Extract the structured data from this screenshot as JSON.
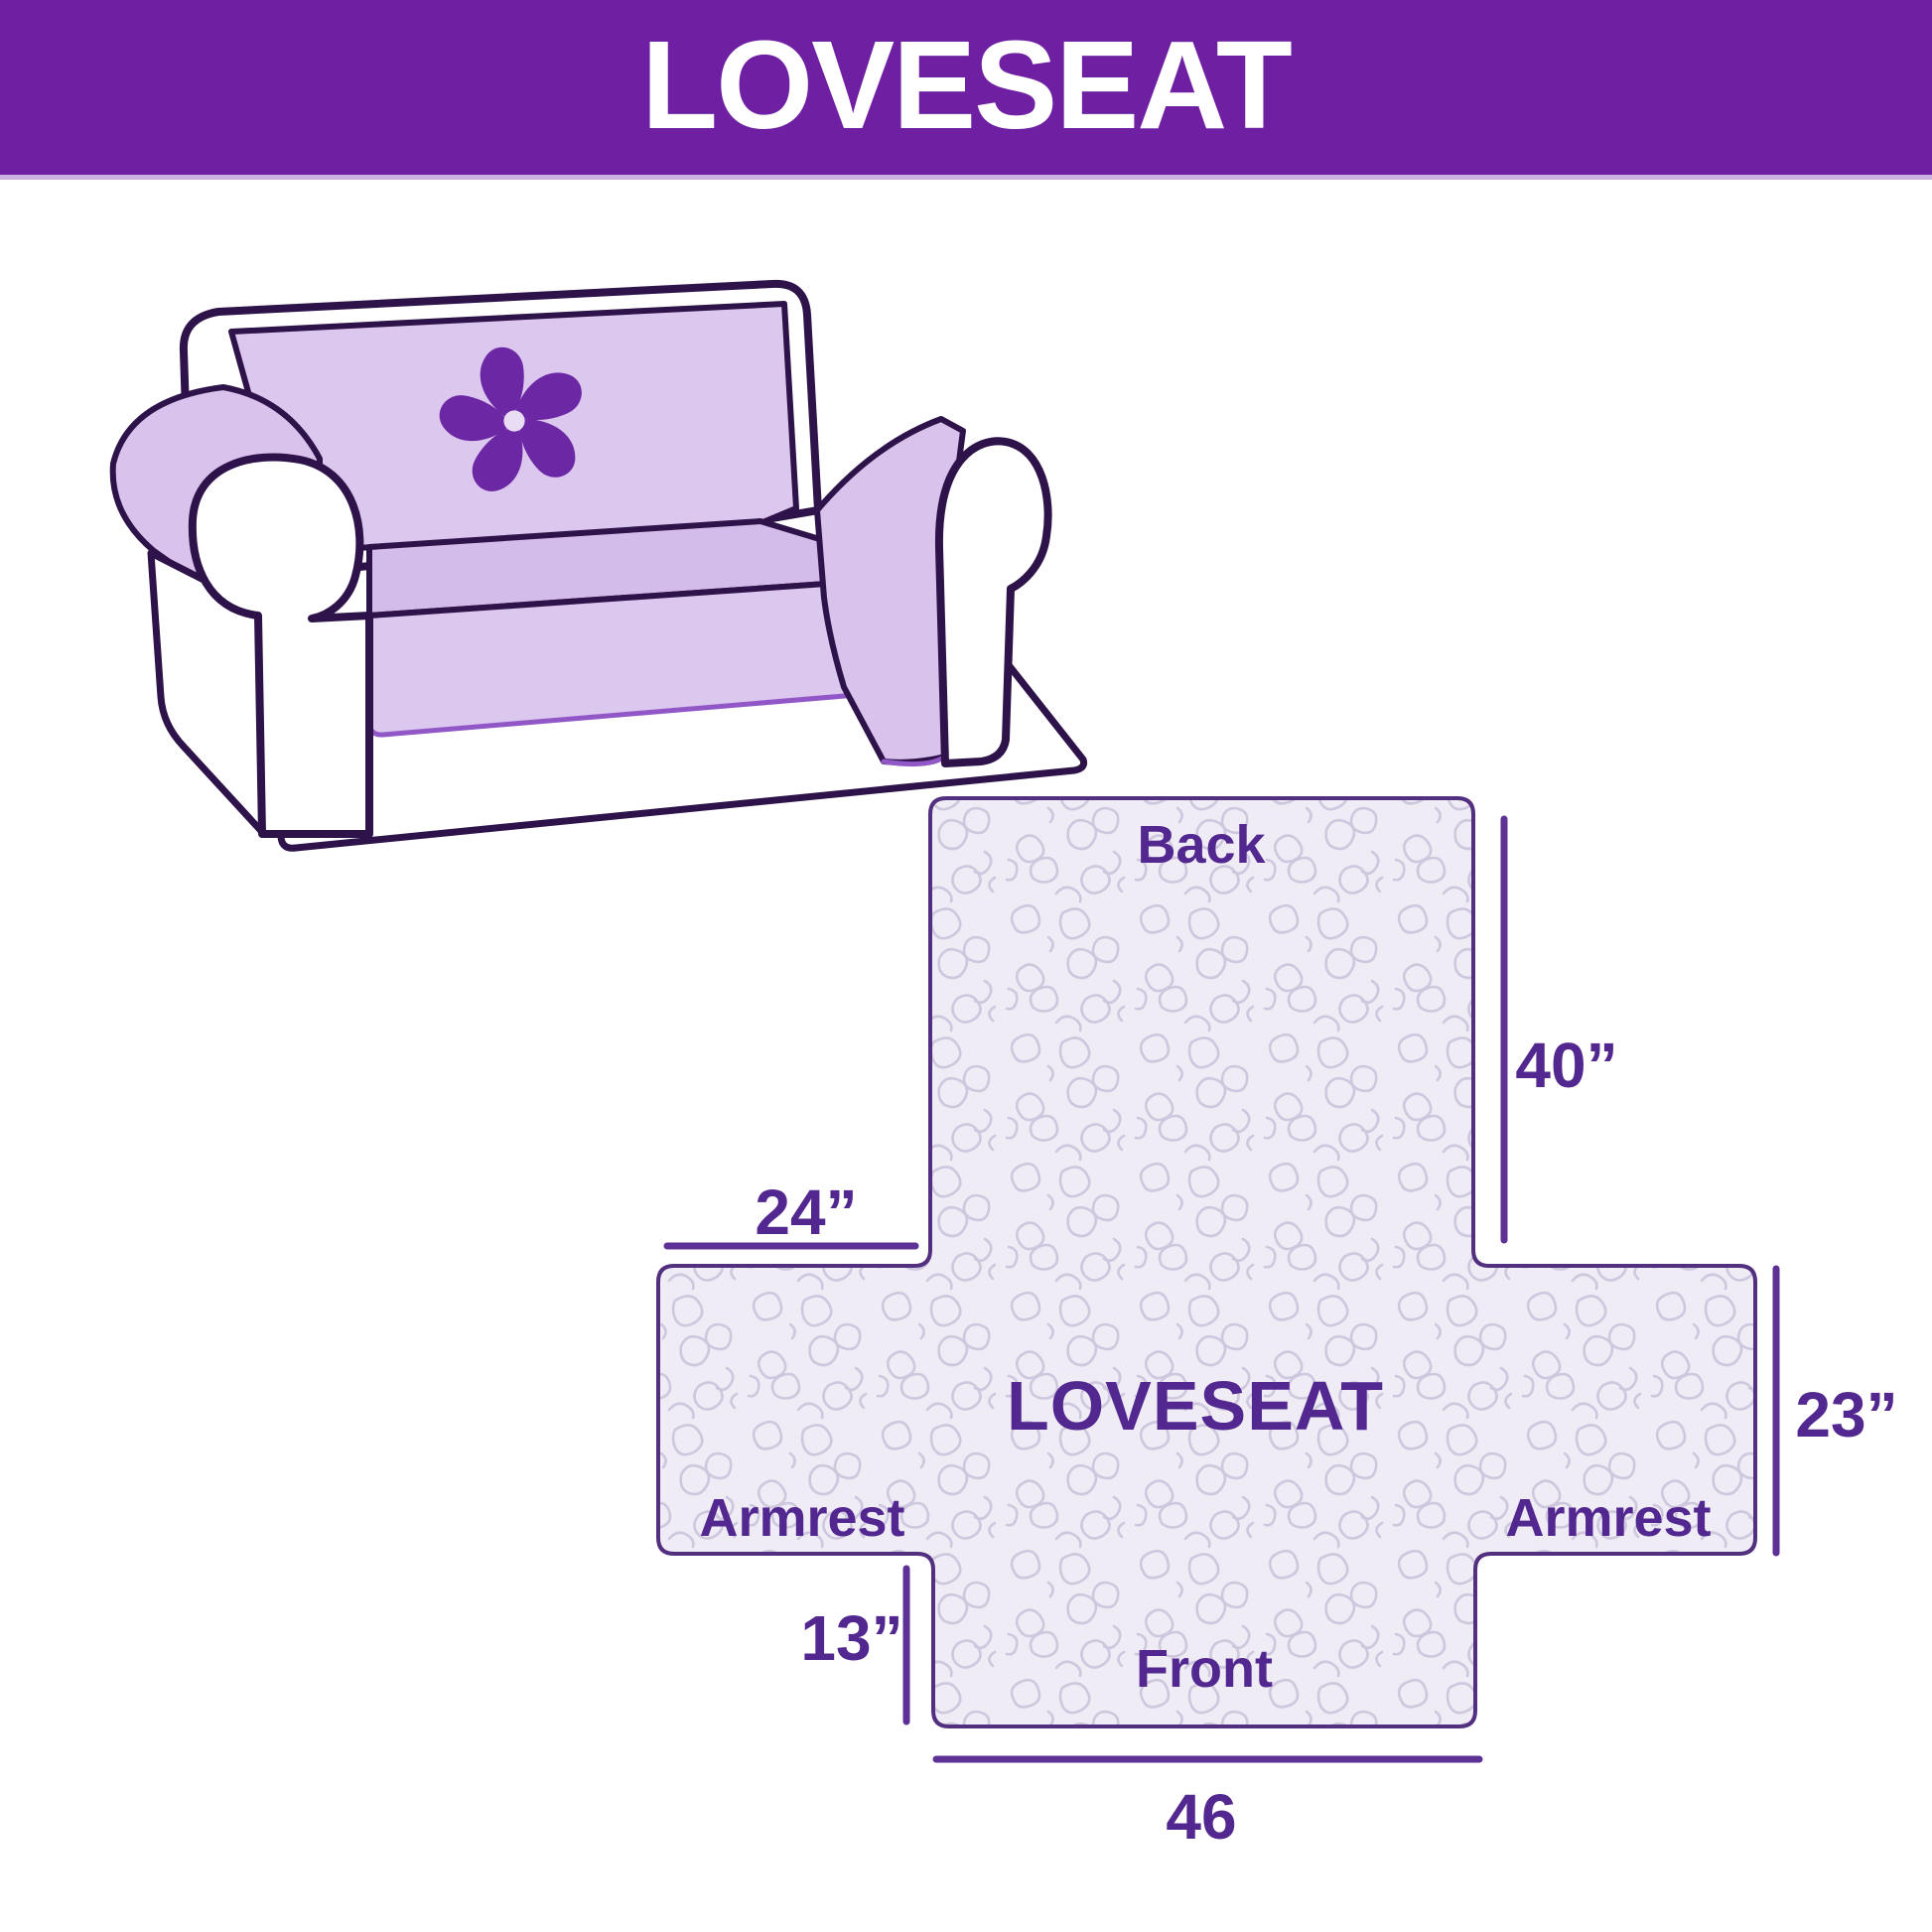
{
  "banner": {
    "title": "LOVESEAT"
  },
  "illustration": {
    "alt": "Loveseat sofa with light purple quilted slipcover and pinwheel logo"
  },
  "diagram": {
    "center_label": "LOVESEAT",
    "panels": {
      "back": "Back",
      "front": "Front",
      "armrest_left": "Armrest",
      "armrest_right": "Armrest"
    },
    "dimensions": {
      "back_height": "40”",
      "back_top_width": "24”",
      "armrest_height": "23”",
      "front_skirt_height": "13”",
      "front_bottom_width": "46"
    }
  },
  "colors": {
    "banner_purple": "#6e1fa2",
    "label_purple": "#52278f",
    "dimension_line_purple": "#5d3196",
    "cover_fill": "#efecf6",
    "pattern_stroke": "#cfc7de",
    "sofa_cover_lavender": "#dcc7ee",
    "sofa_outline": "#2d1349",
    "logo_purple": "#6c28a4"
  }
}
